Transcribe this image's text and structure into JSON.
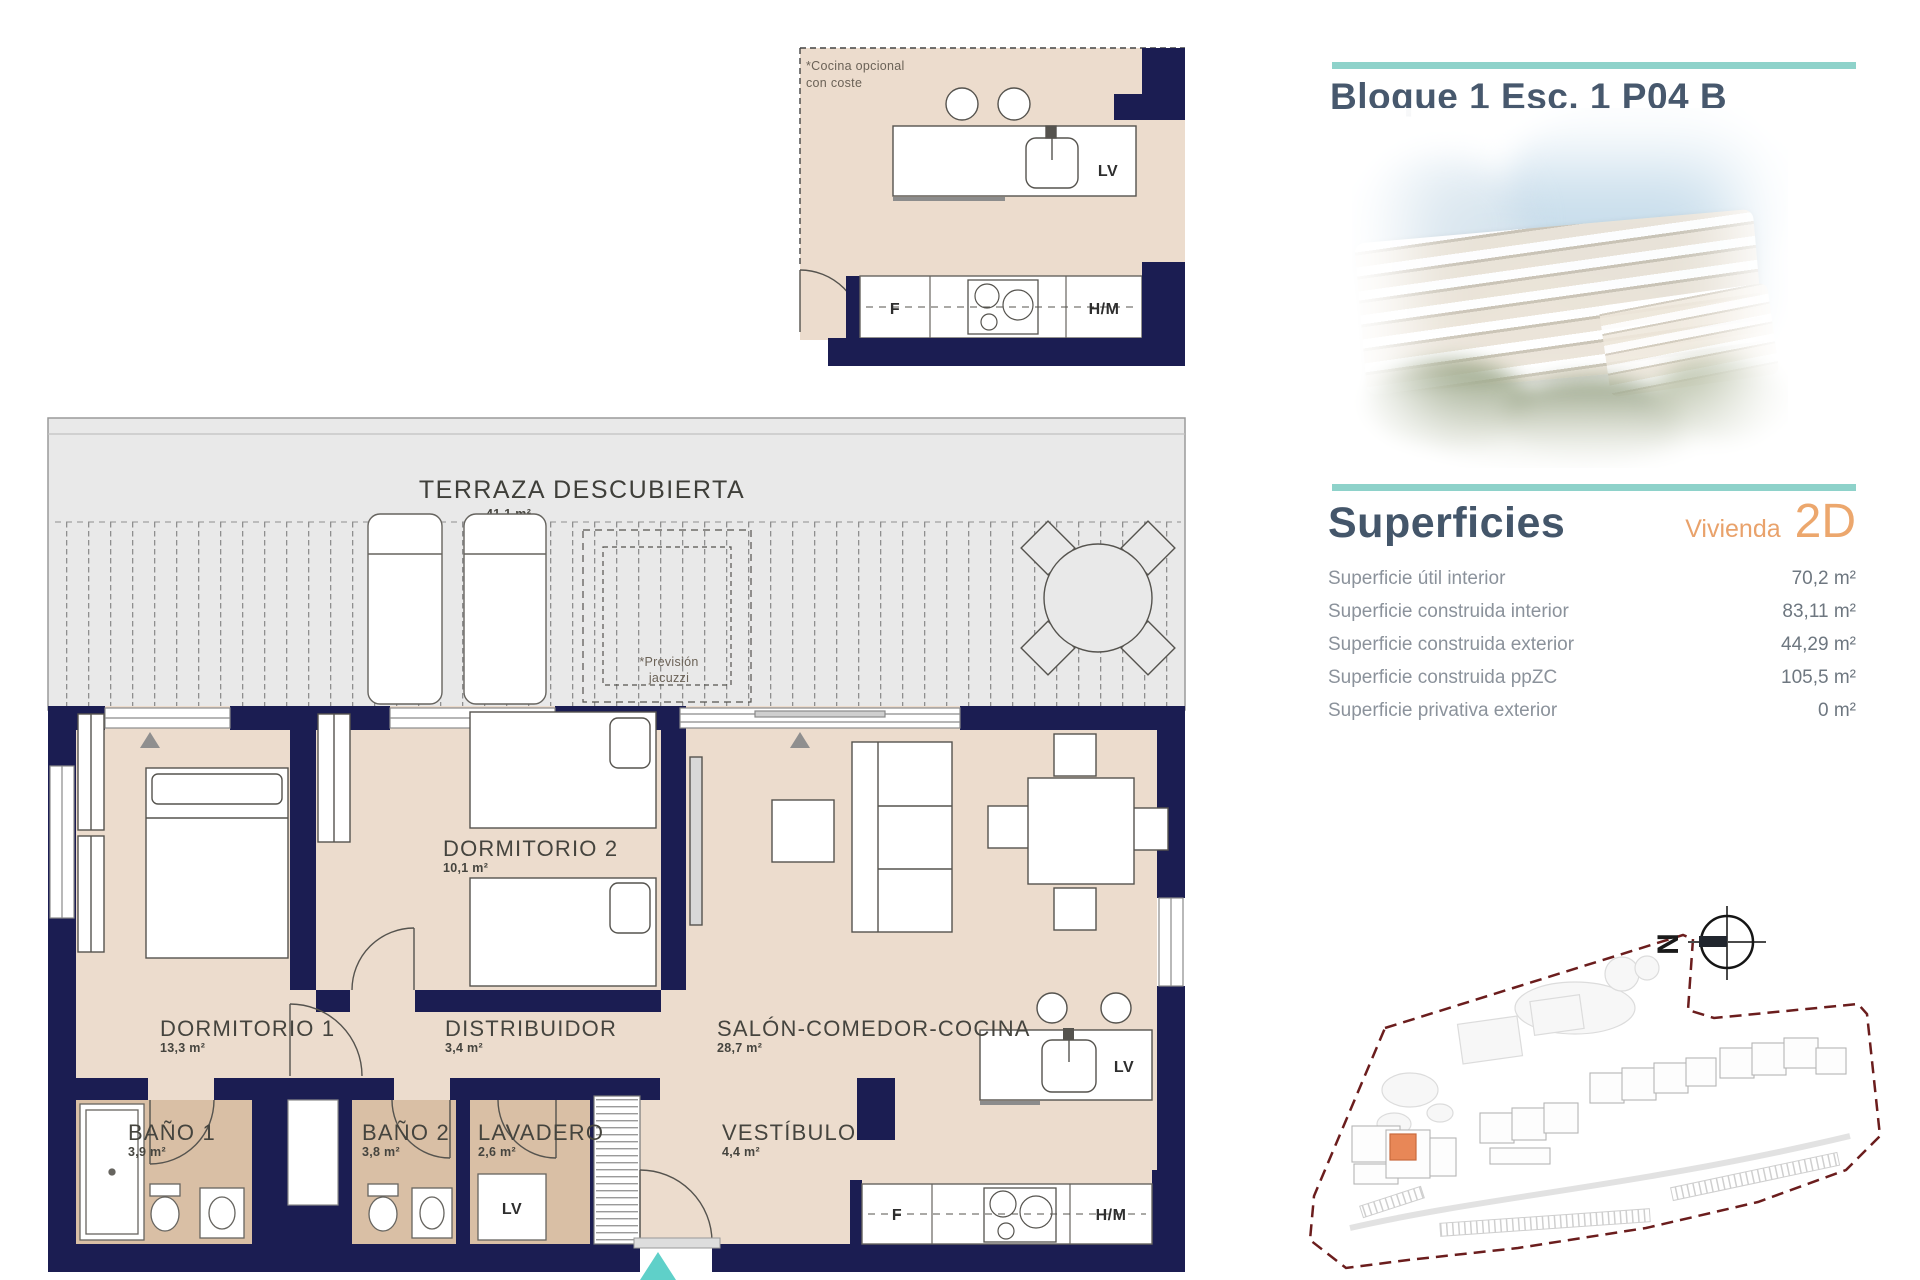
{
  "colors": {
    "teal_accent": "#8ed2ca",
    "navy_wall": "#1b1d52",
    "room_beige": "#ecdccd",
    "bath_tan": "#d9bfa5",
    "terrace_gray": "#e9e9e9",
    "title_slate": "#47586d",
    "orange_accent": "#eca76d",
    "entry_arrow_teal": "#5fd0c9",
    "siteplan_highlight": "#e88757"
  },
  "header": {
    "title": "Bloque 1 Esc. 1 P04 B"
  },
  "superficies": {
    "heading": "Superficies",
    "vivienda_label": "Vivienda",
    "vivienda_code": "2D",
    "rows": [
      {
        "label": "Superficie útil interior",
        "value": "70,2 m²"
      },
      {
        "label": "Superficie construida interior",
        "value": "83,11 m²"
      },
      {
        "label": "Superficie construida exterior",
        "value": "44,29 m²"
      },
      {
        "label": "Superficie construida ppZC",
        "value": "105,5 m²"
      },
      {
        "label": "Superficie privativa exterior",
        "value": "0 m²"
      }
    ]
  },
  "floorplan": {
    "kitchen_detail": {
      "note_line1": "*Cocina opcional",
      "note_line2": "con coste",
      "lv": "LV",
      "f": "F",
      "hm": "H/M"
    },
    "terrace": {
      "name": "TERRAZA DESCUBIERTA",
      "area": "41,1 m²",
      "jacuzzi_line1": "*Previsión",
      "jacuzzi_line2": "jacuzzi"
    },
    "rooms": {
      "dormitorio1": {
        "name": "DORMITORIO 1",
        "area": "13,3 m²"
      },
      "dormitorio2": {
        "name": "DORMITORIO 2",
        "area": "10,1 m²"
      },
      "distribuidor": {
        "name": "DISTRIBUIDOR",
        "area": "3,4 m²"
      },
      "salon": {
        "name": "SALÓN-COMEDOR-COCINA",
        "area": "28,7 m²"
      },
      "bano1": {
        "name": "BAÑO 1",
        "area": "3,9 m²"
      },
      "bano2": {
        "name": "BAÑO 2",
        "area": "3,8 m²"
      },
      "lavadero": {
        "name": "LAVADERO",
        "area": "2,6 m²"
      },
      "vestibulo": {
        "name": "VESTÍBULO",
        "area": "4,4 m²"
      }
    },
    "kitchen": {
      "lv": "LV",
      "f": "F",
      "hm": "H/M"
    },
    "laundry": {
      "lv": "LV"
    }
  },
  "siteplan": {
    "compass_letter": "N"
  }
}
